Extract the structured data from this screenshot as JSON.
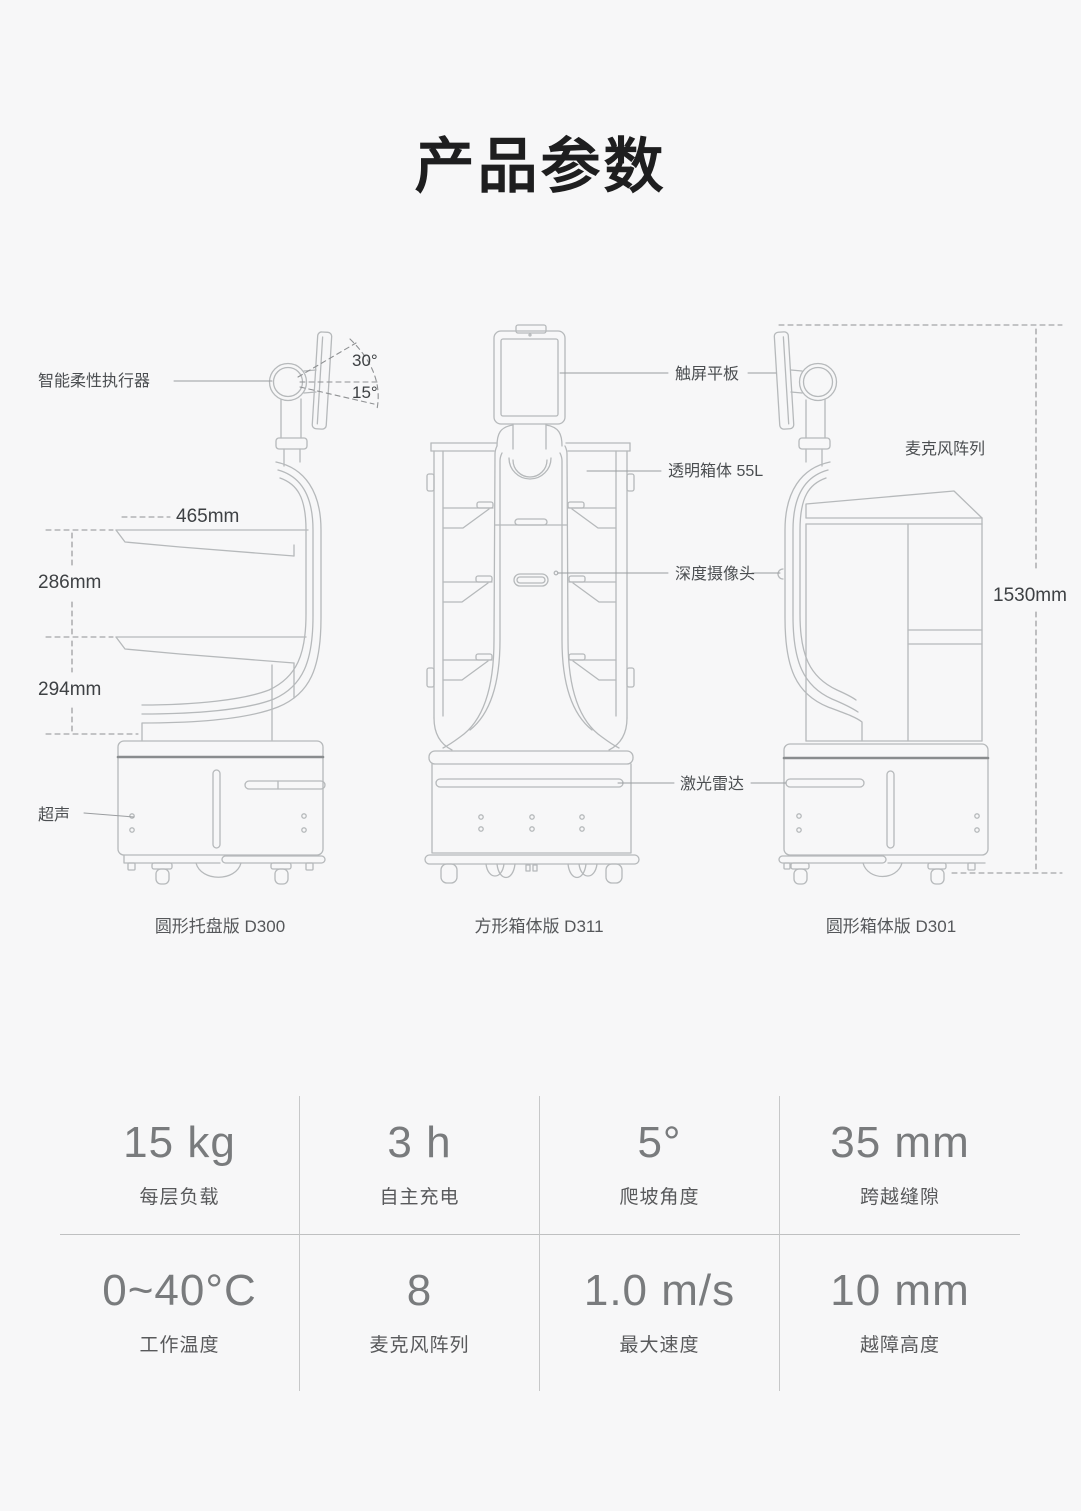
{
  "title": "产品参数",
  "annotations": {
    "actuator": "智能柔性执行器",
    "angle_30": "30°",
    "angle_15": "15°",
    "dim_465": "465mm",
    "dim_286": "286mm",
    "dim_294": "294mm",
    "ultrasound": "超声",
    "touchscreen": "触屏平板",
    "transparent_box": "透明箱体 55L",
    "mic_array": "麦克风阵列",
    "depth_camera": "深度摄像头",
    "lidar": "激光雷达",
    "dim_1530": "1530mm"
  },
  "models": [
    {
      "caption": "圆形托盘版 D300"
    },
    {
      "caption": "方形箱体版 D311"
    },
    {
      "caption": "圆形箱体版 D301"
    }
  ],
  "specs": [
    {
      "value": "15 kg",
      "label": "每层负载"
    },
    {
      "value": "3 h",
      "label": "自主充电"
    },
    {
      "value": "5°",
      "label": "爬坡角度"
    },
    {
      "value": "35 mm",
      "label": "跨越缝隙"
    },
    {
      "value": "0~40°C",
      "label": "工作温度"
    },
    {
      "value": "8",
      "label": "麦克风阵列"
    },
    {
      "value": "1.0 m/s",
      "label": "最大速度"
    },
    {
      "value": "10 mm",
      "label": "越障高度"
    }
  ],
  "colors": {
    "background": "#f7f7f8",
    "line_art": "#b6b9bb",
    "dark_band": "#898c8e",
    "dashed_dim": "#8f9193",
    "title_text": "#1e1e1f",
    "spec_value": "#797b7d",
    "spec_label": "#58595b"
  }
}
